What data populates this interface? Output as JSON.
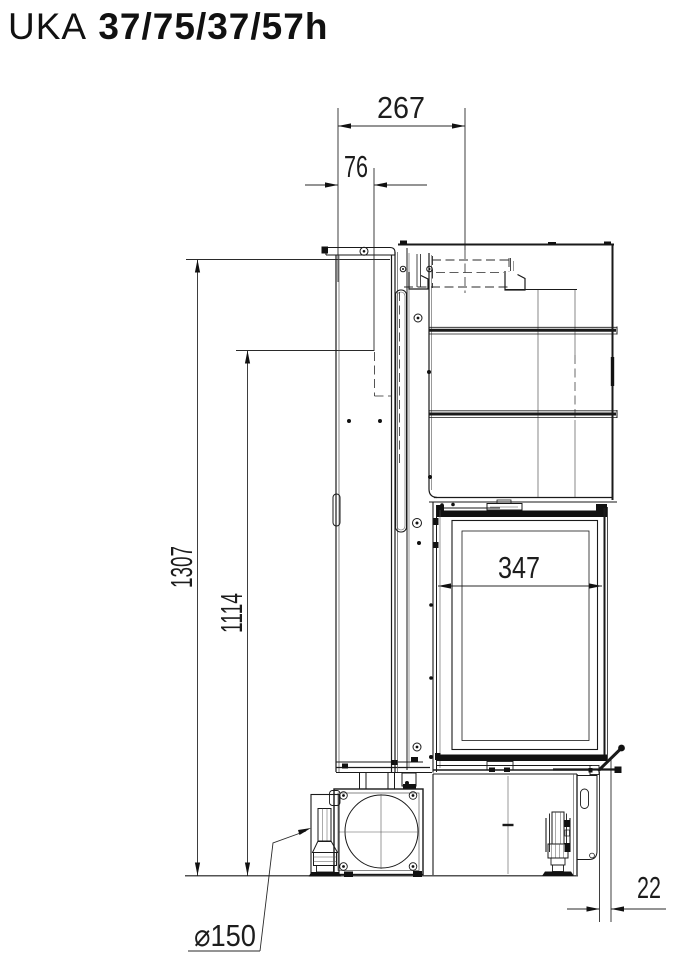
{
  "title": {
    "series": "UKA",
    "model": "37/75/37/57h"
  },
  "dimensions": {
    "top_depth": "267",
    "flue_center_offset": "76",
    "overall_height": "1307",
    "connection_height": "1114",
    "glass_width": "347",
    "front_protrusion": "22",
    "air_inlet_diameter": "⌀150"
  },
  "colors": {
    "line": "#1a1a1a",
    "dimension": "#2a2a2a",
    "background": "#ffffff"
  }
}
